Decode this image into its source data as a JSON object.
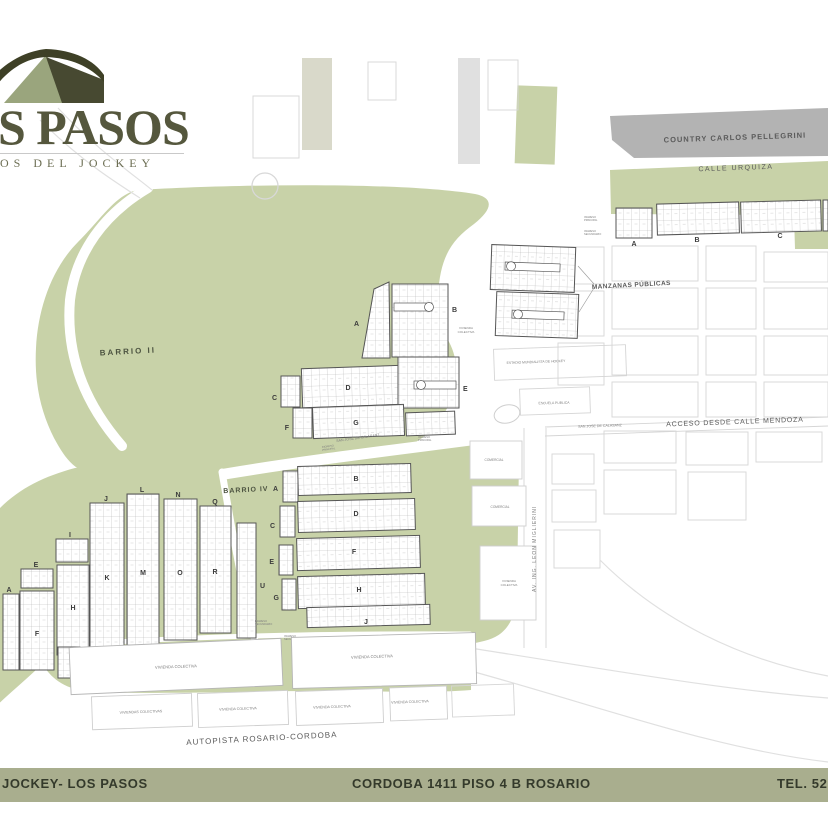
{
  "logo": {
    "title": "S PASOS",
    "subtitle": "OS DEL JOCKEY"
  },
  "map": {
    "country_label": "COUNTRY CARLOS PELLEGRINI",
    "calle_urquiza": "CALLE URQUIZA",
    "barrio_i": "BARRIO I",
    "barrio_ii": "BARRIO II",
    "barrio_iv": "BARRIO IV",
    "manzanas_publicas": "MANZANAS PÚBLICAS",
    "acceso": "ACCESO DESDE CALLE MENDOZA",
    "estadio": "ESTADIO MUNDIALISTA DE HOCKEY",
    "escuela": "ESCUELA PUBLICA",
    "san_jose": "SAN JOSE DE CALASANZ",
    "avenida": "AV. ING. LEON MIGLIERINI",
    "comercial": "COMERCIAL",
    "autopista": "AUTOPISTA ROSARIO-CORDOBA",
    "vivienda": "VIVIENDA",
    "colectiva": "COLECTIVA",
    "vivienda_colectiva": "VIVIENDA COLECTIVA",
    "viviendas_colectivas": "VIVIENDAS COLECTIVAS",
    "ingreso": "INGRESO",
    "principal": "PRINCIPAL",
    "secundario": "SECUNDARIO",
    "barrio_i_blocks": {
      "a": "A",
      "b": "B",
      "c": "C"
    },
    "barrio_ii_blocks": {
      "a": "A",
      "b": "B",
      "c": "C",
      "d": "D",
      "e": "E",
      "f": "F",
      "g": "G"
    },
    "barrio_iv_blocks": {
      "a": "A",
      "b": "B",
      "c": "C",
      "d": "D",
      "e": "E",
      "f": "F",
      "g": "G",
      "h": "H",
      "j": "J",
      "u": "U"
    },
    "west_blocks": {
      "a": "A",
      "d": "D",
      "e": "E",
      "f": "F",
      "h": "H",
      "i": "I",
      "j": "J",
      "k": "K",
      "l": "L",
      "m": "M",
      "n": "N",
      "o": "O",
      "q": "Q",
      "r": "R"
    }
  },
  "footer": {
    "left": "JOCKEY- LOS PASOS",
    "center": "CORDOBA 1411 PISO 4 B ROSARIO",
    "right": "TEL. 52"
  },
  "colors": {
    "green": "#c8d2a8",
    "country_gray": "#b3b3b3",
    "footer_bg": "#a9ae8e",
    "logo_dark": "#3e4026",
    "logo_sage": "#9aa57d"
  }
}
